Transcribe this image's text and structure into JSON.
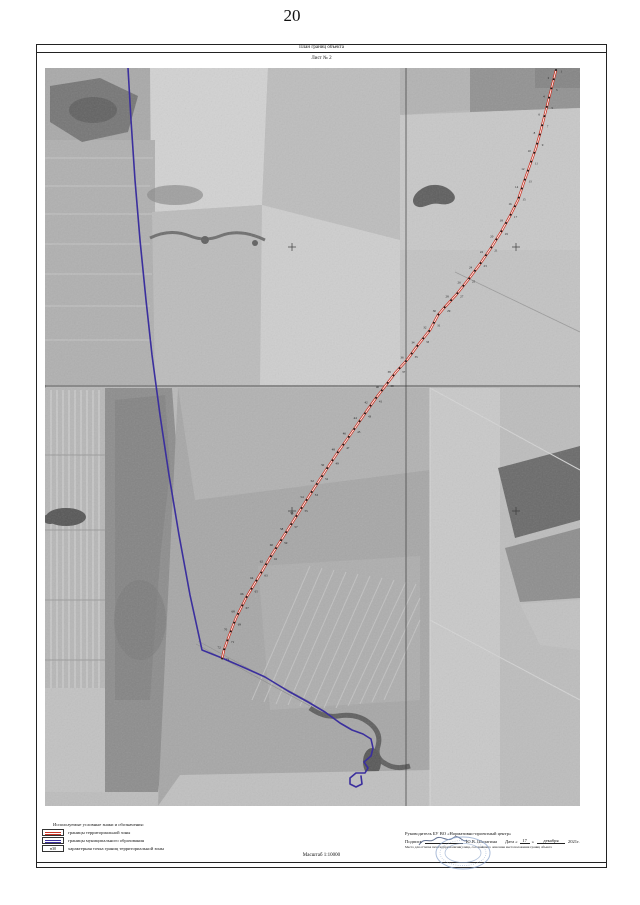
{
  "page": {
    "number": "20"
  },
  "header": {
    "title": "План границ объекта",
    "sheet": "Лист № 2"
  },
  "map": {
    "red_line": {
      "name": "граница территориальной зоны",
      "color": "#c93526",
      "dot_color": "#1a1a1a",
      "dot_spacing": 9.5,
      "points": [
        [
          556,
          70
        ],
        [
          551,
          90
        ],
        [
          546,
          110
        ],
        [
          541,
          130
        ],
        [
          536,
          148
        ],
        [
          530,
          165
        ],
        [
          524,
          182
        ],
        [
          518,
          200
        ],
        [
          510,
          216
        ],
        [
          501,
          232
        ],
        [
          491,
          248
        ],
        [
          480,
          264
        ],
        [
          468,
          280
        ],
        [
          456,
          295
        ],
        [
          444,
          308
        ],
        [
          438,
          315
        ],
        [
          430,
          330
        ],
        [
          418,
          345
        ],
        [
          407,
          360
        ],
        [
          396,
          372
        ],
        [
          386,
          385
        ],
        [
          376,
          398
        ],
        [
          366,
          412
        ],
        [
          357,
          425
        ],
        [
          348,
          438
        ],
        [
          338,
          452
        ],
        [
          326,
          470
        ],
        [
          313,
          490
        ],
        [
          299,
          512
        ],
        [
          285,
          534
        ],
        [
          271,
          556
        ],
        [
          258,
          578
        ],
        [
          246,
          598
        ],
        [
          236,
          618
        ],
        [
          229,
          636
        ],
        [
          224,
          650
        ],
        [
          222,
          659
        ]
      ]
    },
    "blue_line": {
      "name": "граница муниципального образования",
      "color": "#3b2f9e",
      "points": [
        [
          128,
          68
        ],
        [
          131,
          120
        ],
        [
          135,
          180
        ],
        [
          140,
          240
        ],
        [
          146,
          300
        ],
        [
          152,
          355
        ],
        [
          160,
          415
        ],
        [
          169,
          475
        ],
        [
          179,
          535
        ],
        [
          190,
          595
        ],
        [
          202,
          650
        ],
        [
          222,
          658
        ],
        [
          245,
          668
        ],
        [
          265,
          677
        ],
        [
          288,
          691
        ],
        [
          308,
          702
        ],
        [
          325,
          712
        ],
        [
          340,
          723
        ],
        [
          352,
          730
        ],
        [
          363,
          734
        ],
        [
          371,
          739
        ],
        [
          373,
          748
        ],
        [
          371,
          756
        ],
        [
          364,
          762
        ],
        [
          368,
          768
        ],
        [
          365,
          773
        ],
        [
          356,
          773
        ],
        [
          350,
          778
        ],
        [
          350,
          784
        ],
        [
          356,
          787
        ],
        [
          362,
          784
        ],
        [
          361,
          776
        ]
      ]
    },
    "grid": {
      "color": "#3c3c3c",
      "v_line_x": 406,
      "h_line_y": 386,
      "top": 68,
      "bottom": 806,
      "left": 45,
      "right": 580,
      "crosses": [
        [
          516,
          247
        ],
        [
          292,
          247
        ],
        [
          516,
          511
        ],
        [
          292,
          511
        ]
      ]
    },
    "point_labels": [
      "1",
      "2",
      "3",
      "4",
      "5",
      "6",
      "7",
      "8",
      "9",
      "10",
      "11",
      "12",
      "13",
      "14",
      "15",
      "16",
      "17",
      "18",
      "19",
      "20",
      "21",
      "22",
      "23",
      "24",
      "25",
      "26",
      "27",
      "28",
      "29",
      "30",
      "31",
      "32",
      "33",
      "34",
      "35",
      "36",
      "37",
      "38",
      "39",
      "40",
      "41",
      "42",
      "43",
      "44",
      "45",
      "46",
      "47",
      "48",
      "49",
      "50",
      "51",
      "52",
      "53",
      "54",
      "55",
      "56",
      "57",
      "58",
      "59",
      "60",
      "61",
      "62",
      "63",
      "64",
      "65",
      "66",
      "67",
      "68",
      "69",
      "70",
      "71",
      "72",
      "73",
      "74",
      "75",
      "76",
      "77",
      "78",
      "79",
      "80"
    ]
  },
  "legend": {
    "title": "Используемые условные знаки и обозначения:",
    "items": [
      {
        "symbol": "red-double-line",
        "label": "границы территориальной зоны"
      },
      {
        "symbol": "blue-double-line",
        "label": "границы муниципального образования"
      },
      {
        "symbol": "point-label-box",
        "symbol_text": "н30",
        "label": "характерная точка границ территориальной зоны"
      }
    ]
  },
  "scale": {
    "label": "Масштаб 1:10000"
  },
  "signature": {
    "line1": "Руководитель БУ ВО «Нормативно-проектный центр»",
    "podpis_label": "Подпись",
    "name": "Ю.В. Шалагина",
    "date_prefix": "Дата «",
    "day": "17",
    "date_close": "»",
    "month": "декабря",
    "year": "2021г.",
    "line3": "Место для оттиска печати (при наличии) лица, составившего описание местоположения границ объекта"
  }
}
